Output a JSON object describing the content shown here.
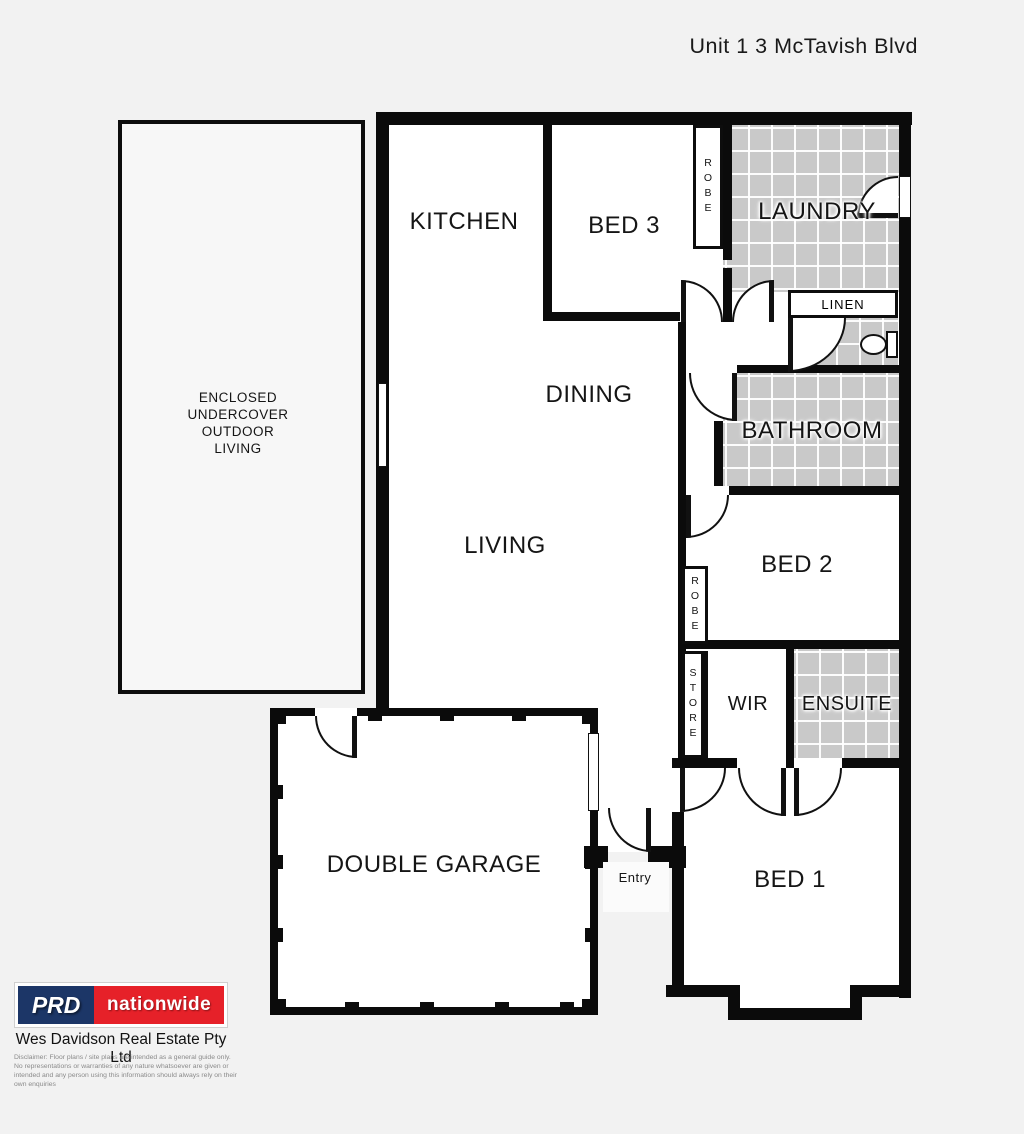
{
  "title": "Unit 1  3 McTavish Blvd",
  "plan": {
    "rooms": {
      "kitchen": "KITCHEN",
      "bed3": "BED 3",
      "robe_bed3": "ROBE",
      "laundry": "LAUNDRY",
      "linen": "LINEN",
      "dining": "DINING",
      "bathroom": "BATHROOM",
      "living": "LIVING",
      "bed2": "BED 2",
      "robe_bed2": "ROBE",
      "store": "STORE",
      "wir": "WIR",
      "ensuite": "ENSUITE",
      "garage": "DOUBLE GARAGE",
      "entry": "Entry",
      "bed1": "BED 1",
      "outdoor": "ENCLOSED\nUNDERCOVER\nOUTDOOR\nLIVING"
    }
  },
  "footer": {
    "logo_left": "PRD",
    "logo_right": "nationwide",
    "agency": "Wes Davidson Real Estate Pty Ltd",
    "disclaimer": "Disclaimer: Floor plans / site plans are intended as a general guide only. No representations or warranties of any nature whatsoever are given or intended and any person using this information should always rely on their own enquiries"
  },
  "colors": {
    "background": "#f2f2f2",
    "wall": "#0b0b0b",
    "tile": "#c9c9c9",
    "navy": "#1c3667",
    "red": "#e62129"
  }
}
